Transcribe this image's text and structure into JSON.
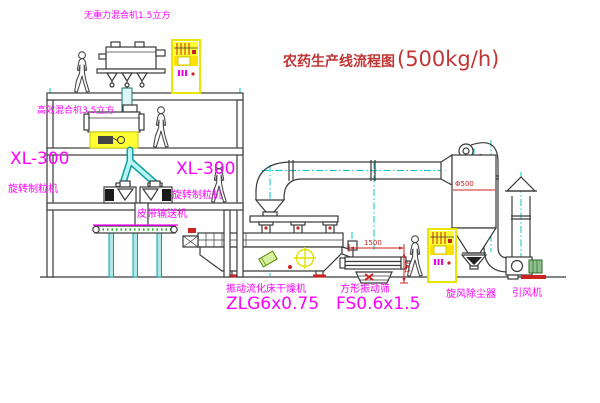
{
  "title": {
    "text_cn": "农药生产线流程图",
    "capacity": "(500kg/h)"
  },
  "equipment_labels": {
    "gravity_free_mixer": "无重力混合机1.5立方",
    "high_efficiency_mixer": "高效混合机3.5立方",
    "granulator_left_model": "XL-300",
    "granulator_left_name": "旋转制粒机",
    "granulator_right_model": "XL-300",
    "granulator_right_name": "旋转制粒机",
    "belt_conveyor": "皮带输送机",
    "fluid_bed_dryer_name": "振动流化床干燥机",
    "fluid_bed_dryer_model": "ZLG6x0.75",
    "vibrating_screen_name": "方形振动筛",
    "vibrating_screen_model": "FS0.6x1.5",
    "cyclone_dust_collector": "旋风除尘器",
    "induced_draft_fan": "引风机"
  },
  "dimensions": {
    "screen_length": "1500",
    "screen_side": "341",
    "cyclone_dia": "Φ500"
  },
  "colors": {
    "label_magenta": "#ff00ff",
    "title_red": "#c23535",
    "line_dark": "#3a3a3a",
    "pipe_cyan": "#00c8c8",
    "highlight_yellow": "#ffff00",
    "dim_red": "#cc2222",
    "conveyor_green": "#00aa00"
  }
}
